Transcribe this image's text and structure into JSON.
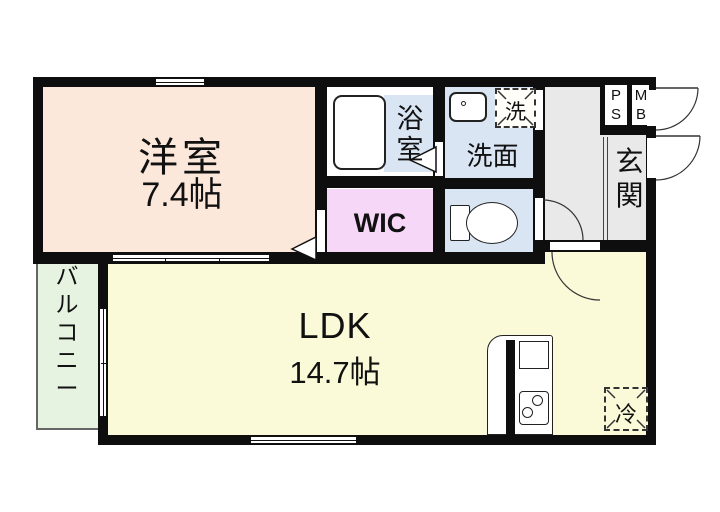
{
  "floorplan": {
    "title": "1LDK apartment floor plan",
    "rooms": {
      "yoshitsu": {
        "name": "洋室",
        "size": "7.4帖",
        "color": "#fce8da"
      },
      "ldk": {
        "name": "LDK",
        "size": "14.7帖",
        "color": "#fafad8"
      },
      "wic": {
        "name": "WIC",
        "color": "#f7d7f7"
      },
      "bathroom": {
        "name": "浴室",
        "color": "#d9e5f3"
      },
      "washroom": {
        "name": "洗面",
        "color": "#d9e5f3"
      },
      "toilet": {
        "name": "",
        "color": "#d9e5f3"
      },
      "balcony": {
        "name": "バルコニー",
        "color": "#e7f3e1"
      },
      "genkan": {
        "name": "玄関",
        "color": "#e9e9e9"
      },
      "ps": {
        "name": "PS"
      },
      "mb": {
        "name": "MB"
      }
    },
    "fixtures": {
      "washer": {
        "label": "洗"
      },
      "fridge": {
        "label": "冷"
      }
    },
    "colors": {
      "wall": "#0e0e0e",
      "water_rooms": "#d9e5f3",
      "background": "#ffffff"
    }
  }
}
